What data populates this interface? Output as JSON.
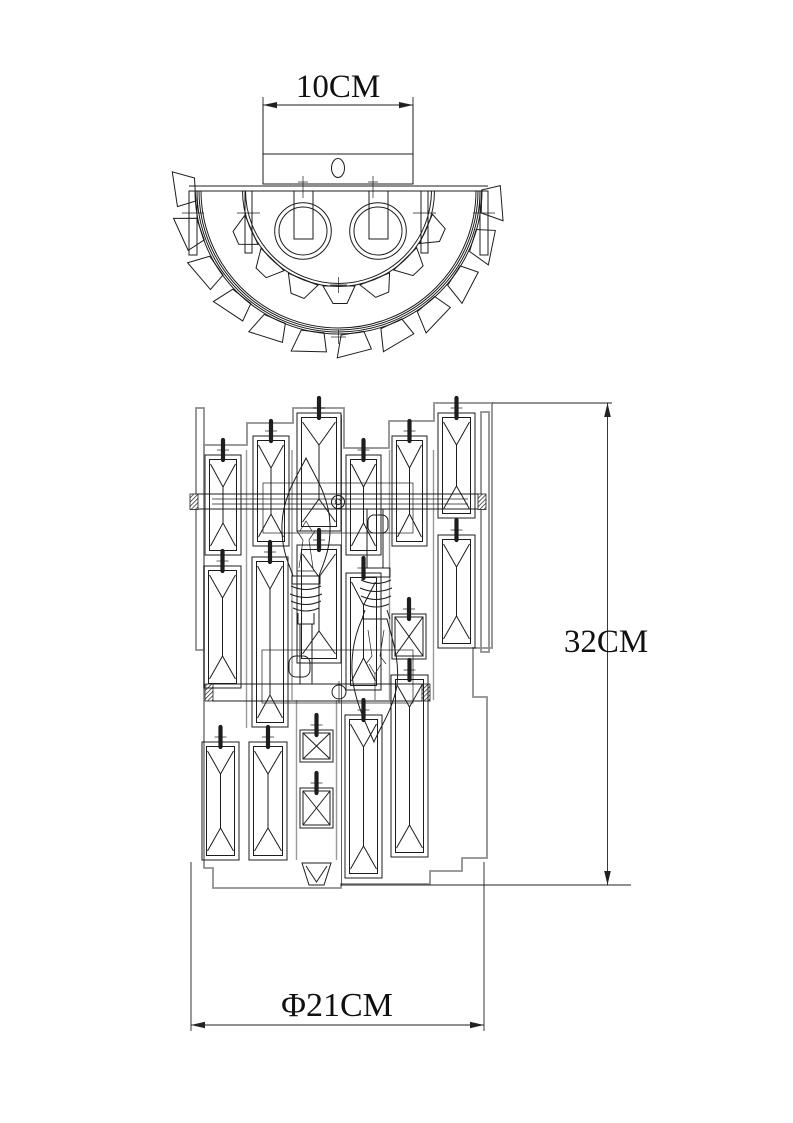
{
  "page": {
    "background_color": "#ffffff",
    "line_color": "#1d1d1d",
    "secondary_line_color": "#8f8f8f"
  },
  "drawing": {
    "description": "Dimensioned technical drawing of a two-light crystal wall sconce, shown in top view and front view",
    "top_view": {
      "width_label": "10CM"
    },
    "front_view": {
      "height_label": "32CM",
      "diameter_label": "Φ21CM"
    }
  }
}
